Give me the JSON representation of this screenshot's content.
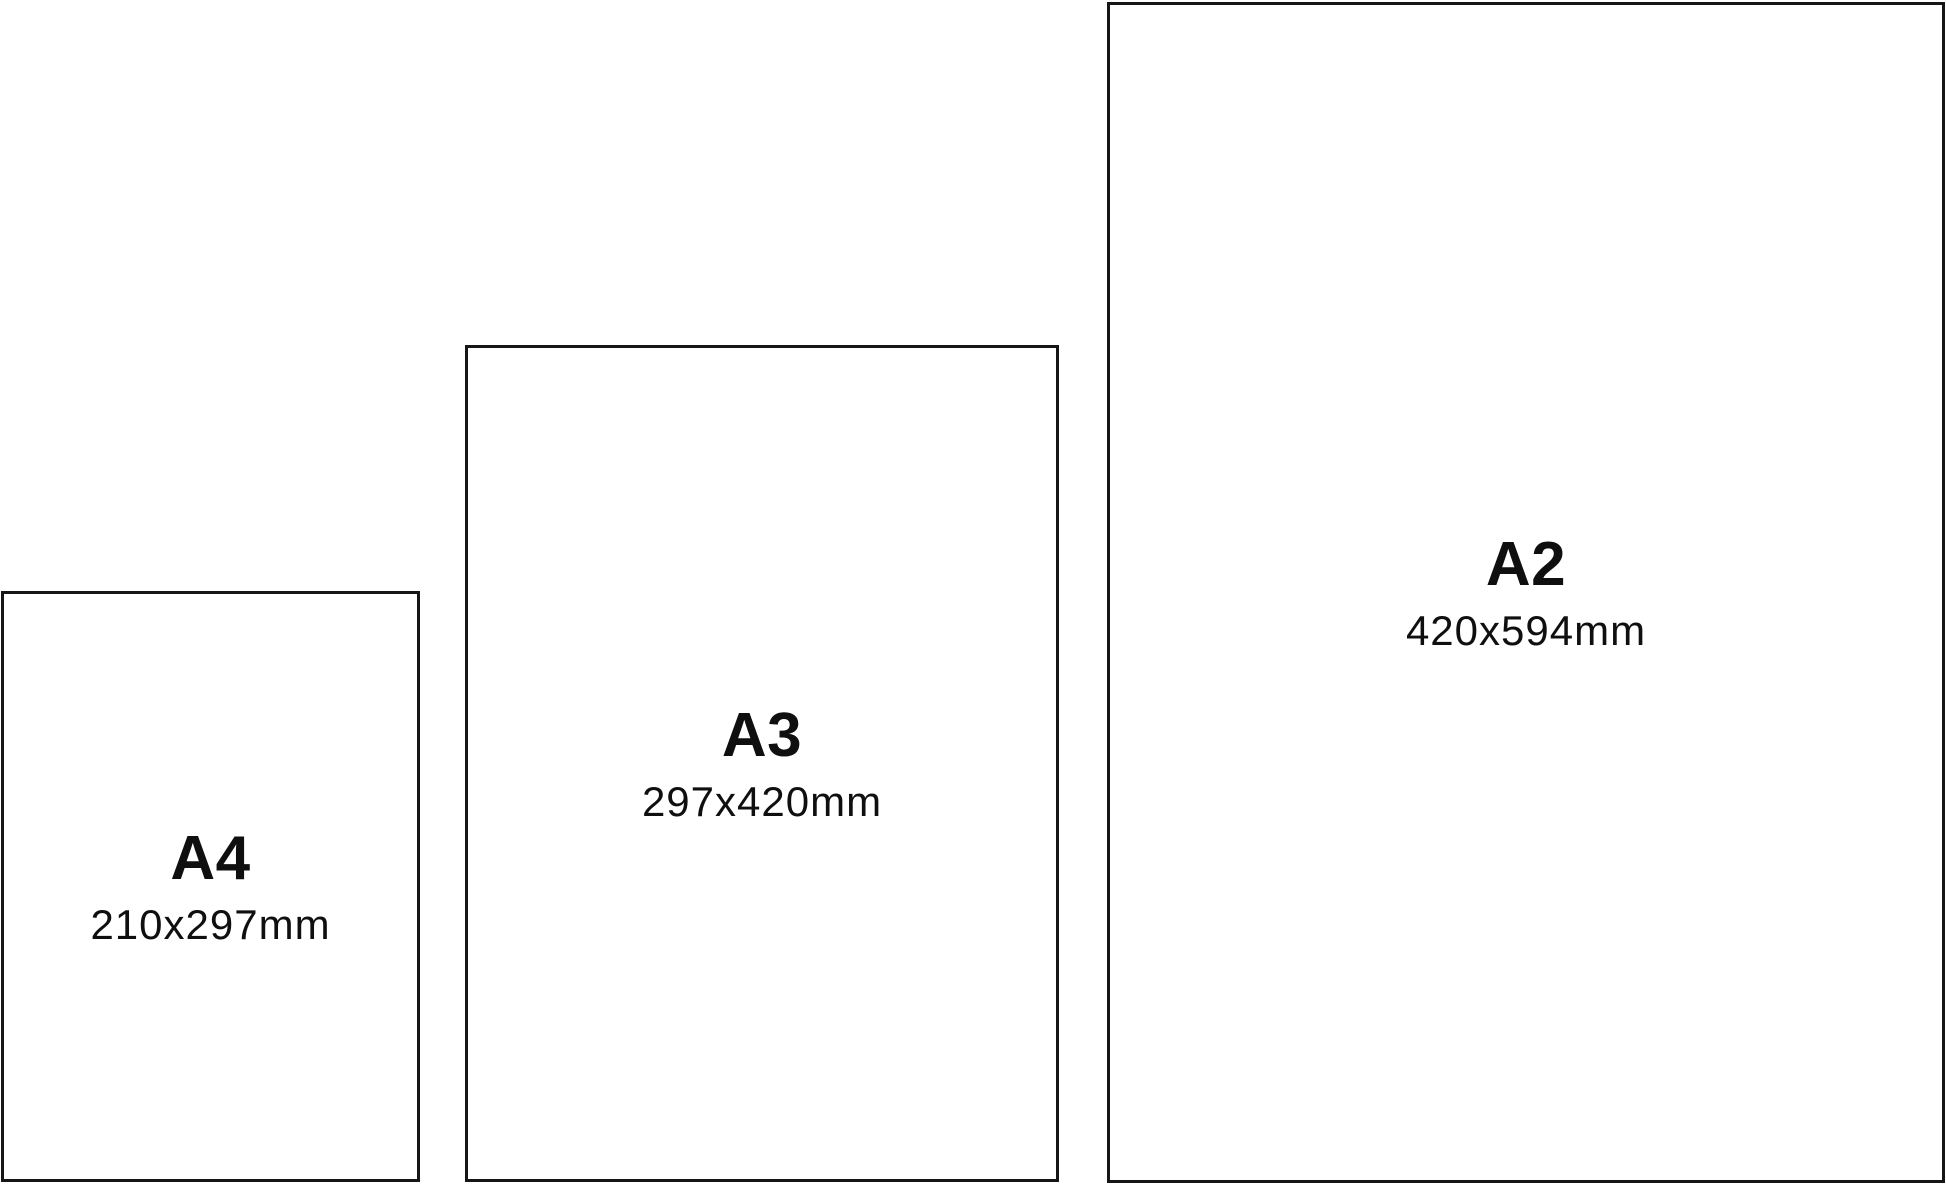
{
  "diagram": {
    "description": "Paper size comparison"
  },
  "papers": [
    {
      "name": "A4",
      "dimensions": "210x297mm"
    },
    {
      "name": "A3",
      "dimensions": "297x420mm"
    },
    {
      "name": "A2",
      "dimensions": "420x594mm"
    }
  ],
  "colors": {
    "border": "#161616",
    "text": "#0f0f0f",
    "background": "#ffffff"
  }
}
